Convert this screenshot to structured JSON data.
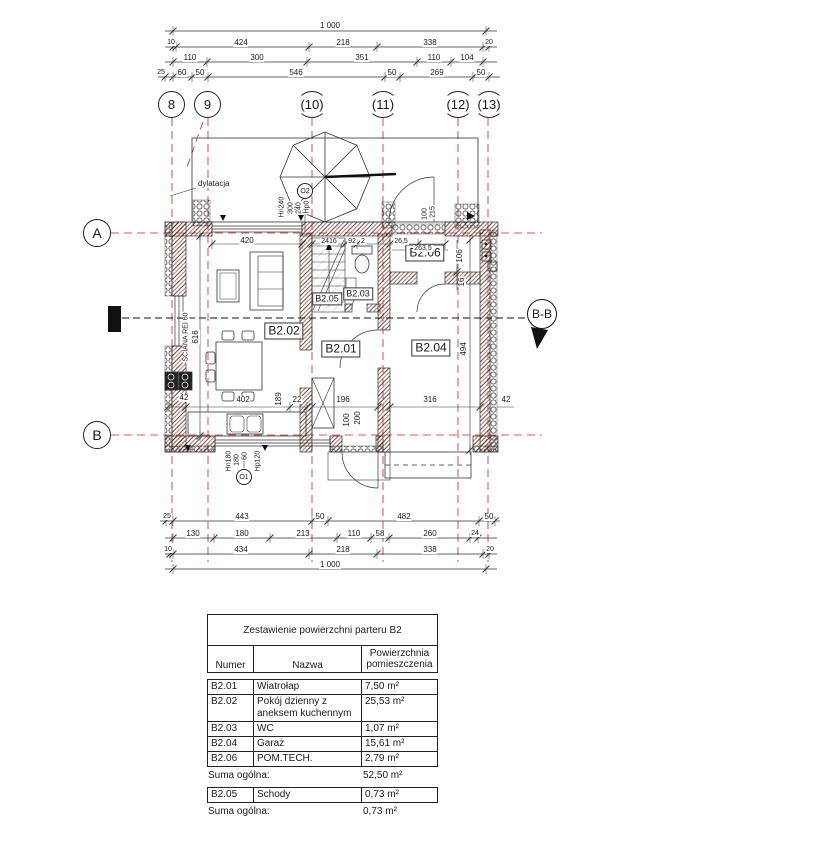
{
  "grid": {
    "bubbles": [
      "8",
      "9",
      "(10)",
      "(11)",
      "(12)",
      "(13)"
    ],
    "axis_a": "A",
    "axis_b": "B",
    "section": "B-B"
  },
  "rooms": {
    "b201": "B2.01",
    "b202": "B2.02",
    "b203": "B2.03",
    "b204": "B2.04",
    "b205": "B2.05",
    "b206": "B2.06"
  },
  "annotations": {
    "dylatacja": "dylatacja",
    "sciana": "SCIANA REI 60",
    "sciana_dim": "616",
    "o2": "O2",
    "o1": "O1",
    "o2_dims": [
      "Hn240",
      "300",
      "240",
      "Hp0"
    ],
    "o1_dims": [
      "Hn180",
      "180",
      "60",
      "Hp120"
    ],
    "door_dims": [
      "100",
      "215"
    ]
  },
  "dims": {
    "top": {
      "total": "1 000",
      "r2": [
        "10",
        "424",
        "218",
        "338",
        "20"
      ],
      "r3": [
        "110",
        "300",
        "351",
        "110",
        "104"
      ],
      "r4": [
        "25",
        "60",
        "50",
        "546",
        "50",
        "269",
        "50"
      ]
    },
    "bottom": {
      "r1": [
        "25",
        "443",
        "50",
        "482",
        "50"
      ],
      "r2": [
        "130",
        "180",
        "213",
        "110",
        "58",
        "260",
        "24"
      ],
      "r3": [
        "10",
        "434",
        "218",
        "338",
        "20"
      ],
      "total": "1 000"
    },
    "inner": {
      "a": "420",
      "b": "2416",
      "c": "92",
      "d": "2",
      "e": "26,5",
      "f": "263,5",
      "g": "106",
      "h": "16",
      "i": "494",
      "j": "42",
      "k": "402",
      "l": "189",
      "m": "22",
      "n": "196",
      "o": "100",
      "p": "200",
      "q": "316",
      "r": "42"
    }
  },
  "tables": {
    "main": {
      "title": "Zestawienie powierzchni parteru B2",
      "col_numer": "Numer",
      "col_nazwa": "Nazwa",
      "col_pow": "Powierzchnia pomieszczenia",
      "rows": [
        {
          "num": "B2.01",
          "name": "Wiatrołap",
          "area": "7,50 m²"
        },
        {
          "num": "B2.02",
          "name": "Pokój dzienny z aneksem kuchennym",
          "area": "25,53 m²"
        },
        {
          "num": "B2.03",
          "name": "WC",
          "area": "1,07 m²"
        },
        {
          "num": "B2.04",
          "name": "Garaż",
          "area": "15,61 m²"
        },
        {
          "num": "B2.06",
          "name": "POM.TECH.",
          "area": "2,79 m²"
        }
      ],
      "suma_label": "Suma ogólna:",
      "suma_value": "52,50 m²"
    },
    "stairs": {
      "rows": [
        {
          "num": "B2.05",
          "name": "Schody",
          "area": "0,73 m²"
        }
      ],
      "suma_label": "Suma ogólna:",
      "suma_value": "0,73 m²"
    }
  }
}
